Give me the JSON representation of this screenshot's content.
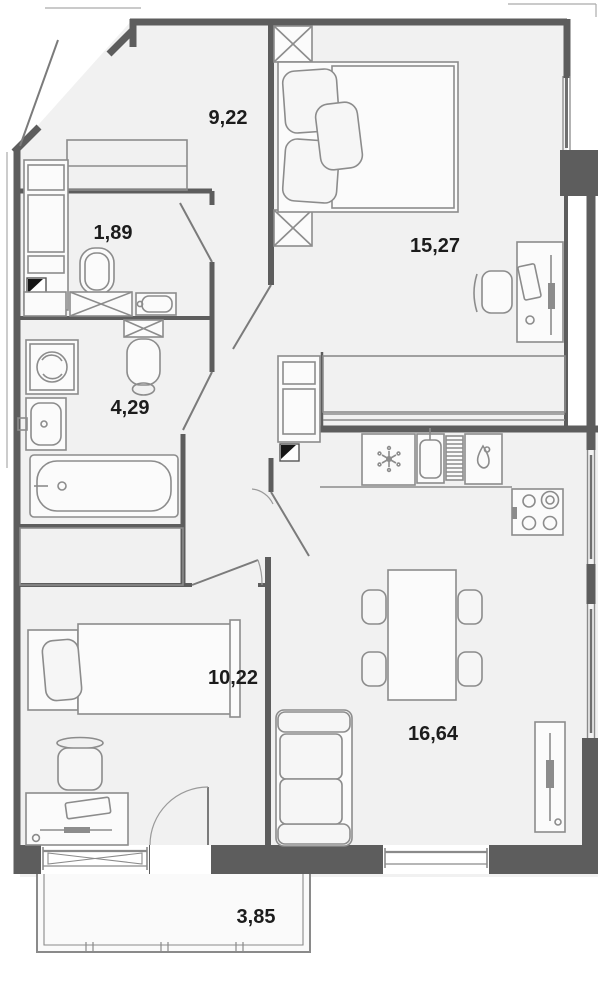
{
  "plan": {
    "type": "apartment-floor-plan",
    "area_unit_format": "comma-decimal",
    "rooms": [
      {
        "id": "hallway",
        "area": "9,22"
      },
      {
        "id": "wc",
        "area": "1,89"
      },
      {
        "id": "bathroom",
        "area": "4,29"
      },
      {
        "id": "bedroom-1",
        "area": "15,27"
      },
      {
        "id": "bedroom-2",
        "area": "10,22"
      },
      {
        "id": "kitchen-living-room",
        "area": "16,64"
      },
      {
        "id": "balcony",
        "area": "3,85"
      }
    ],
    "fixtures": {
      "hallway": [
        "entrance-door",
        "wardrobe"
      ],
      "wc": [
        "toilet",
        "washbasin",
        "cabinet",
        "ventilation-shaft"
      ],
      "bathroom": [
        "washing-machine",
        "toilet",
        "washbasin",
        "bathtub"
      ],
      "bedroom_1": [
        "double-bed",
        "nightstand",
        "nightstand",
        "desk",
        "chair",
        "wardrobe",
        "window"
      ],
      "bedroom_2": [
        "single-bed",
        "chair",
        "desk",
        "wardrobe",
        "balcony-door",
        "window"
      ],
      "kitchen_living_room": [
        "refrigerator",
        "kitchen-sink",
        "dishwasher",
        "stove",
        "dining-table",
        "chairs",
        "sofa",
        "radiator",
        "window"
      ],
      "balcony": [
        "railing"
      ]
    },
    "colors": {
      "wall": "#5d5d5d",
      "floor": "#f1f1f1",
      "furniture": "#8c8c8c",
      "label": "#1c1c1c",
      "background": "#ffffff",
      "vent": "#161616"
    }
  }
}
